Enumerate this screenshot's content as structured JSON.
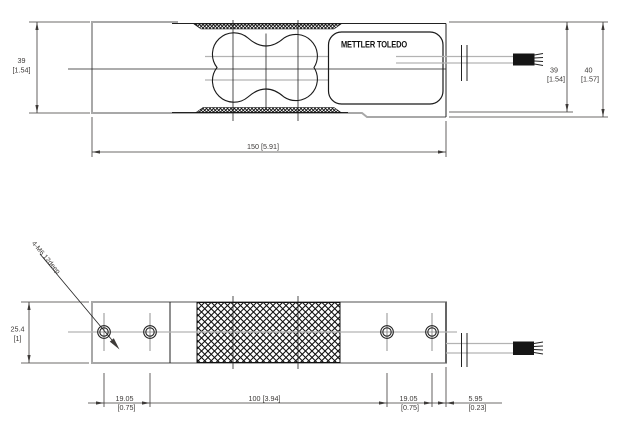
{
  "drawing": {
    "brand_label": "METTLER TOLEDO",
    "side_view": {
      "height_left_mm": "39",
      "height_left_in": "[1.54]",
      "length_label": "150 [5.91]",
      "height_right_mm": "39",
      "height_right_in": "[1.54]",
      "overall_height_mm": "40",
      "overall_height_in": "[1.57]"
    },
    "plan_view": {
      "thread_callout": "4-M6 12deep",
      "width_mm": "25.4",
      "width_in": "[1]",
      "hole_pitch_left_mm": "19.05",
      "hole_pitch_left_in": "[0.75]",
      "hole_span_label": "100 [3.94]",
      "hole_pitch_right_mm": "19.05",
      "hole_pitch_right_in": "[0.75]",
      "end_offset_mm": "5.95",
      "end_offset_in": "[0.23]"
    }
  }
}
